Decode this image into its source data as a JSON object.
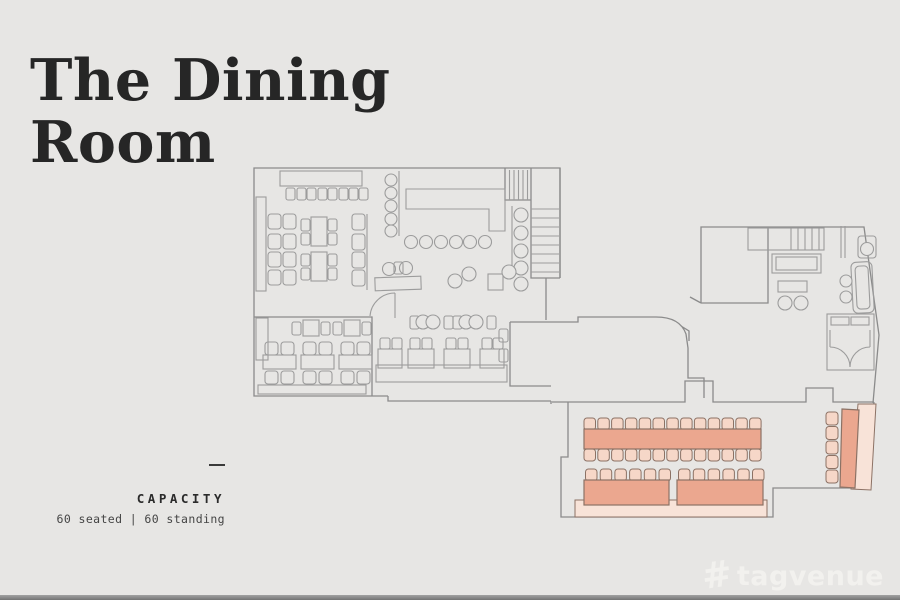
{
  "page": {
    "background_color": "#E7E6E4",
    "bottom_bar_color": "#8C8C8C"
  },
  "header": {
    "title_line1": "The Dining",
    "title_line2": "Room"
  },
  "capacity": {
    "label": "CAPACITY",
    "value": "60 seated | 60 standing"
  },
  "watermark": {
    "brand": "tagvenue",
    "logo_glyph": "#"
  },
  "floor_plan": {
    "wall_color": "#8B8B8B",
    "furniture_line_color": "#9C9C9C",
    "highlight_colors": {
      "table": "#EBA78F",
      "chair": "#F6D7C8",
      "banquette": "#F8E3D8",
      "outline": "#8C7265"
    },
    "highlighted_furniture": {
      "long_table": {
        "chairs_top": 13,
        "chairs_bottom": 13
      },
      "banquet_table_left": {
        "chairs": 6
      },
      "banquet_table_right": {
        "chairs": 6
      },
      "side_table": {
        "chairs": 5
      }
    }
  }
}
